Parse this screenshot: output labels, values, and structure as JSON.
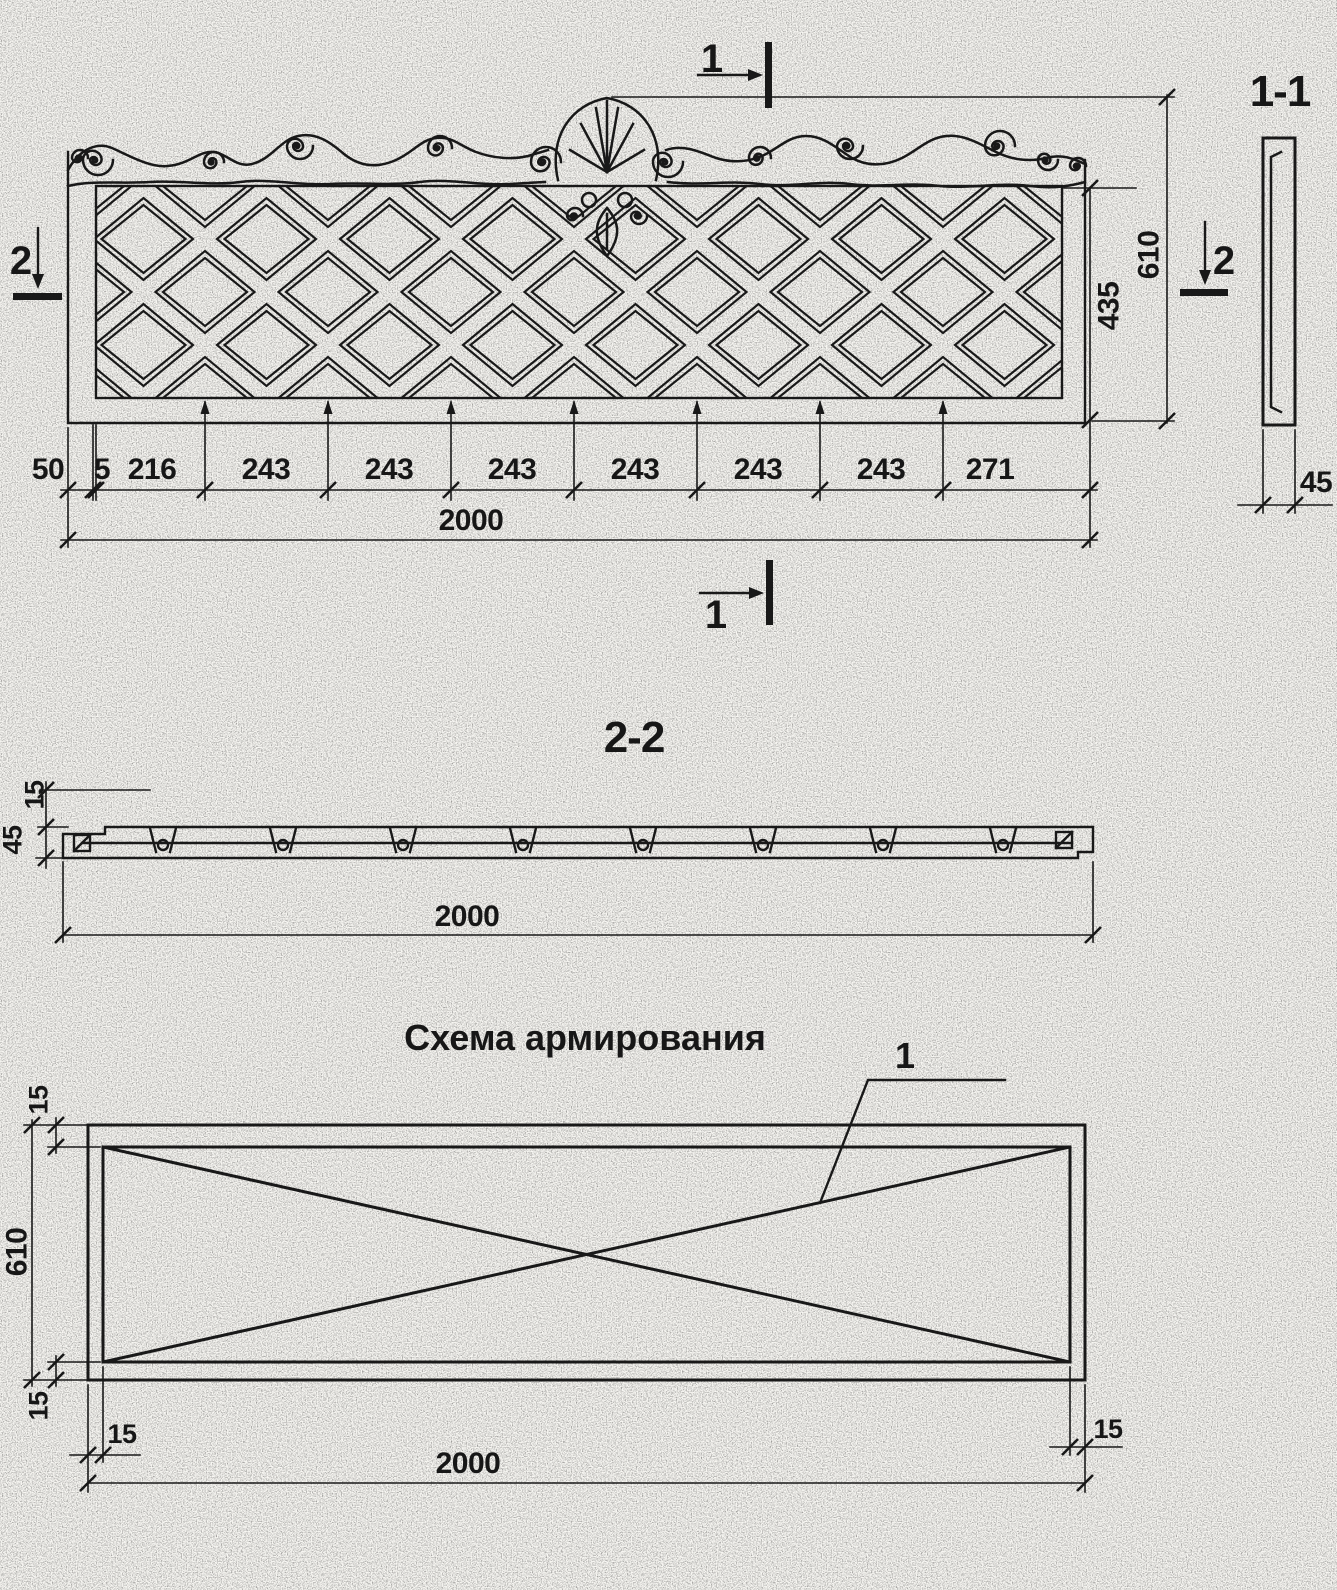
{
  "front_view": {
    "marker_top": "1",
    "marker_bottom": "1",
    "marker_left": "2",
    "marker_right": "2",
    "segments": [
      "50",
      "5",
      "216",
      "243",
      "243",
      "243",
      "243",
      "243",
      "243",
      "271"
    ],
    "total_length": "2000",
    "lattice_height": "435",
    "total_height": "610"
  },
  "section_1_1": {
    "title": "1-1",
    "thickness": "45"
  },
  "section_2_2": {
    "title": "2-2",
    "lip": "15",
    "thickness": "45",
    "length": "2000"
  },
  "scheme": {
    "title": "Схема армирования",
    "callout": "1",
    "cover_top": "15",
    "height": "610",
    "cover_bottom": "15",
    "cover_left": "15",
    "cover_right": "15",
    "length": "2000"
  }
}
